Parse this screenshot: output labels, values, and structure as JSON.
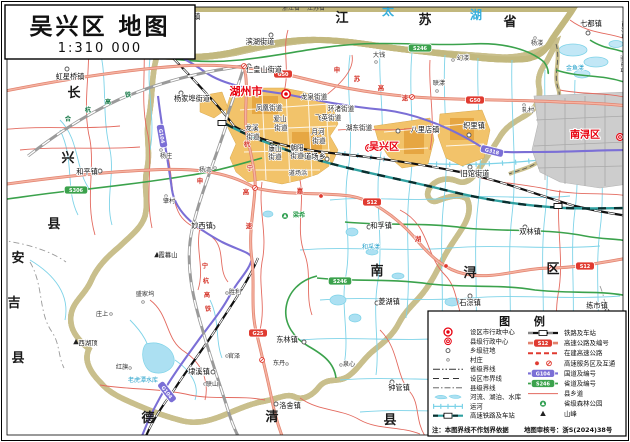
{
  "title": {
    "name": "吴兴区 地图",
    "scale": "1:310 000"
  },
  "colors": {
    "lake": "#C2E7F6",
    "district_fill": "#FCF9D2",
    "boundary_band": "#C9BF8C",
    "urban_orange": "#F2C36A",
    "urban_gray": "#CDCDCD",
    "highway": "#EE9B8C",
    "national_road": "#7B6FD6",
    "provincial_road": "#3BA24C",
    "county_road": "#E36A5F",
    "river": "#7ED3E8",
    "hsr_teal": "#2FA0A0",
    "badge_red": "#E03A30",
    "label_red": "#E8000E"
  },
  "map": {
    "labels": [
      {
        "t": "江",
        "x": 342,
        "y": 22,
        "c": "rg"
      },
      {
        "t": "苏",
        "x": 425,
        "y": 24,
        "c": "rg"
      },
      {
        "t": "省",
        "x": 510,
        "y": 26,
        "c": "rg"
      },
      {
        "t": "太",
        "x": 388,
        "y": 15,
        "c": "wb"
      },
      {
        "t": "湖",
        "x": 476,
        "y": 19,
        "c": "wb"
      },
      {
        "t": "长",
        "x": 74,
        "y": 97,
        "c": "rg"
      },
      {
        "t": "兴",
        "x": 68,
        "y": 162,
        "c": "rg"
      },
      {
        "t": "县",
        "x": 54,
        "y": 228,
        "c": "rg"
      },
      {
        "t": "安",
        "x": 18,
        "y": 262,
        "c": "rg"
      },
      {
        "t": "吉",
        "x": 14,
        "y": 307,
        "c": "rg"
      },
      {
        "t": "县",
        "x": 18,
        "y": 362,
        "c": "rg"
      },
      {
        "t": "德",
        "x": 148,
        "y": 422,
        "c": "rg"
      },
      {
        "t": "清",
        "x": 272,
        "y": 421,
        "c": "rg"
      },
      {
        "t": "县",
        "x": 390,
        "y": 424,
        "c": "rg"
      },
      {
        "t": "南",
        "x": 377,
        "y": 275,
        "c": "rg"
      },
      {
        "t": "浔",
        "x": 470,
        "y": 277,
        "c": "rg"
      },
      {
        "t": "区",
        "x": 553,
        "y": 273,
        "c": "rg"
      },
      {
        "t": "浙江省",
        "x": 291,
        "y": 10,
        "c": "pv"
      },
      {
        "t": "江苏省",
        "x": 316,
        "y": 10,
        "c": "pv"
      },
      {
        "t": "江苏省",
        "x": 622,
        "y": 30,
        "c": "pv",
        "r": 90
      },
      {
        "t": "浙江省",
        "x": 621,
        "y": 64,
        "c": "pv",
        "r": 90
      },
      {
        "t": "湖州市",
        "x": 246,
        "y": 95,
        "c": "ct"
      },
      {
        "t": "吴兴区",
        "x": 384,
        "y": 150,
        "c": "dt"
      },
      {
        "t": "南浔区",
        "x": 585,
        "y": 138,
        "c": "dt"
      },
      {
        "t": "李家巷镇",
        "x": 186,
        "y": 19,
        "c": "tn"
      },
      {
        "t": "虹星桥镇",
        "x": 70,
        "y": 79,
        "c": "tn"
      },
      {
        "t": "七都镇",
        "x": 591,
        "y": 26,
        "c": "tn"
      },
      {
        "t": "滨湖街道",
        "x": 260,
        "y": 44,
        "c": "tn"
      },
      {
        "t": "仁皇山街道",
        "x": 264,
        "y": 72,
        "c": "tn"
      },
      {
        "t": "杨家埠街道",
        "x": 192,
        "y": 101,
        "c": "tn"
      },
      {
        "t": "和平镇",
        "x": 87,
        "y": 174,
        "c": "tn"
      },
      {
        "t": "妙西镇",
        "x": 202,
        "y": 228,
        "c": "tn"
      },
      {
        "t": "埭溪镇",
        "x": 199,
        "y": 374,
        "c": "tn"
      },
      {
        "t": "东林镇",
        "x": 287,
        "y": 342,
        "c": "tn"
      },
      {
        "t": "洛舍镇",
        "x": 290,
        "y": 408,
        "c": "tn"
      },
      {
        "t": "钟管镇",
        "x": 399,
        "y": 390,
        "c": "tn"
      },
      {
        "t": "菱湖镇",
        "x": 389,
        "y": 304,
        "c": "tn"
      },
      {
        "t": "石淙镇",
        "x": 470,
        "y": 305,
        "c": "tn"
      },
      {
        "t": "练市镇",
        "x": 597,
        "y": 308,
        "c": "tn"
      },
      {
        "t": "双林镇",
        "x": 530,
        "y": 234,
        "c": "tn"
      },
      {
        "t": "和孚镇",
        "x": 381,
        "y": 228,
        "c": "tn"
      },
      {
        "t": "旧馆街道",
        "x": 475,
        "y": 176,
        "c": "tn"
      },
      {
        "t": "八里店镇",
        "x": 425,
        "y": 132,
        "c": "tn"
      },
      {
        "t": "织里镇",
        "x": 474,
        "y": 128,
        "c": "tn"
      },
      {
        "t": "道场乡",
        "x": 315,
        "y": 159,
        "c": "tn"
      },
      {
        "t": "龙泉街道",
        "x": 314,
        "y": 99,
        "c": "st"
      },
      {
        "t": "凤凰街道",
        "x": 269,
        "y": 110,
        "c": "st"
      },
      {
        "t": "环渚街道",
        "x": 341,
        "y": 111,
        "c": "st"
      },
      {
        "t": "飞英街道",
        "x": 328,
        "y": 120,
        "c": "st"
      },
      {
        "t": "湖东街道",
        "x": 359,
        "y": 130,
        "c": "st"
      },
      {
        "t": "爱山",
        "x": 280,
        "y": 121,
        "c": "st"
      },
      {
        "t": "街道",
        "x": 281,
        "y": 130,
        "c": "st"
      },
      {
        "t": "龙溪",
        "x": 252,
        "y": 130,
        "c": "st"
      },
      {
        "t": "街道",
        "x": 253,
        "y": 139,
        "c": "st"
      },
      {
        "t": "月河",
        "x": 318,
        "y": 134,
        "c": "st"
      },
      {
        "t": "街道",
        "x": 319,
        "y": 143,
        "c": "st"
      },
      {
        "t": "康山",
        "x": 275,
        "y": 151,
        "c": "st"
      },
      {
        "t": "街道",
        "x": 275,
        "y": 159,
        "c": "st"
      },
      {
        "t": "朝阳",
        "x": 297,
        "y": 150,
        "c": "st"
      },
      {
        "t": "街道",
        "x": 297,
        "y": 158,
        "c": "st"
      },
      {
        "t": "大钱",
        "x": 379,
        "y": 57,
        "c": "vg"
      },
      {
        "t": "幻溇",
        "x": 463,
        "y": 60,
        "c": "vg"
      },
      {
        "t": "杨溇",
        "x": 537,
        "y": 45,
        "c": "vg"
      },
      {
        "t": "联漾",
        "x": 439,
        "y": 85,
        "c": "vg"
      },
      {
        "t": "轧村",
        "x": 528,
        "y": 112,
        "c": "vg"
      },
      {
        "t": "杨庄",
        "x": 166,
        "y": 158,
        "c": "vg"
      },
      {
        "t": "杨湾",
        "x": 205,
        "y": 172,
        "c": "vg"
      },
      {
        "t": "肇村",
        "x": 169,
        "y": 203,
        "c": "vg"
      },
      {
        "t": "盛家坞",
        "x": 145,
        "y": 296,
        "c": "vg"
      },
      {
        "t": "庄上",
        "x": 102,
        "y": 316,
        "c": "vg"
      },
      {
        "t": "红旗",
        "x": 122,
        "y": 369,
        "c": "vg"
      },
      {
        "t": "联山",
        "x": 212,
        "y": 386,
        "c": "vg"
      },
      {
        "t": "官泽",
        "x": 234,
        "y": 358,
        "c": "vg"
      },
      {
        "t": "东丹",
        "x": 279,
        "y": 365,
        "c": "vg"
      },
      {
        "t": "泉心",
        "x": 349,
        "y": 366,
        "c": "vg"
      },
      {
        "t": "胜利",
        "x": 235,
        "y": 294,
        "c": "vg"
      },
      {
        "t": "道场浜",
        "x": 298,
        "y": 175,
        "c": "vg"
      },
      {
        "t": "霞幕山",
        "x": 168,
        "y": 257,
        "c": "pk"
      },
      {
        "t": "西湖顶",
        "x": 88,
        "y": 345,
        "c": "pk"
      },
      {
        "t": "老虎潭水库",
        "x": 143,
        "y": 382,
        "c": "ws"
      },
      {
        "t": "金鱼漾",
        "x": 575,
        "y": 70,
        "c": "ws"
      },
      {
        "t": "和孚漾",
        "x": 371,
        "y": 249,
        "c": "ws"
      },
      {
        "t": "合",
        "x": 68,
        "y": 121,
        "c": "rg2"
      },
      {
        "t": "杭",
        "x": 88,
        "y": 112,
        "c": "rg2"
      },
      {
        "t": "高",
        "x": 108,
        "y": 104,
        "c": "rg2"
      },
      {
        "t": "铁",
        "x": 128,
        "y": 97,
        "c": "rg2"
      },
      {
        "t": "宁",
        "x": 205,
        "y": 268,
        "c": "rr"
      },
      {
        "t": "杭",
        "x": 206,
        "y": 283,
        "c": "rr"
      },
      {
        "t": "高",
        "x": 207,
        "y": 297,
        "c": "rr"
      },
      {
        "t": "铁",
        "x": 208,
        "y": 311,
        "c": "rr"
      },
      {
        "t": "申",
        "x": 337,
        "y": 72,
        "c": "hc"
      },
      {
        "t": "苏",
        "x": 357,
        "y": 81,
        "c": "hc"
      },
      {
        "t": "高",
        "x": 381,
        "y": 90,
        "c": "hc"
      },
      {
        "t": "速",
        "x": 405,
        "y": 100,
        "c": "hc"
      },
      {
        "t": "申",
        "x": 200,
        "y": 183,
        "c": "hc"
      },
      {
        "t": "嘉",
        "x": 300,
        "y": 193,
        "c": "hc"
      },
      {
        "t": "湖",
        "x": 418,
        "y": 241,
        "c": "hc"
      },
      {
        "t": "杭",
        "x": 247,
        "y": 146,
        "c": "hc"
      },
      {
        "t": "宁",
        "x": 250,
        "y": 170,
        "c": "hc"
      },
      {
        "t": "高",
        "x": 246,
        "y": 194,
        "c": "hc"
      },
      {
        "t": "速",
        "x": 249,
        "y": 228,
        "c": "hc"
      },
      {
        "t": "梁希",
        "x": 299,
        "y": 217,
        "c": "pg"
      }
    ],
    "markers": [
      {
        "k": "city",
        "x": 286,
        "y": 94
      },
      {
        "k": "county",
        "x": 369,
        "y": 148
      },
      {
        "k": "county",
        "x": 620,
        "y": 137
      },
      {
        "k": "town",
        "x": 172,
        "y": 19
      },
      {
        "k": "town",
        "x": 67,
        "y": 69
      },
      {
        "k": "town",
        "x": 588,
        "y": 33
      },
      {
        "k": "town",
        "x": 271,
        "y": 35
      },
      {
        "k": "town",
        "x": 249,
        "y": 66
      },
      {
        "k": "town",
        "x": 181,
        "y": 93
      },
      {
        "k": "town",
        "x": 100,
        "y": 171
      },
      {
        "k": "town",
        "x": 213,
        "y": 227
      },
      {
        "k": "town",
        "x": 213,
        "y": 372
      },
      {
        "k": "town",
        "x": 304,
        "y": 342
      },
      {
        "k": "town",
        "x": 276,
        "y": 404
      },
      {
        "k": "town",
        "x": 392,
        "y": 382
      },
      {
        "k": "town",
        "x": 377,
        "y": 303
      },
      {
        "k": "town",
        "x": 470,
        "y": 296
      },
      {
        "k": "town",
        "x": 607,
        "y": 311
      },
      {
        "k": "town",
        "x": 525,
        "y": 227
      },
      {
        "k": "town",
        "x": 369,
        "y": 227
      },
      {
        "k": "town",
        "x": 470,
        "y": 167
      },
      {
        "k": "town",
        "x": 398,
        "y": 131
      },
      {
        "k": "town",
        "x": 469,
        "y": 135
      },
      {
        "k": "town",
        "x": 327,
        "y": 159
      },
      {
        "k": "village",
        "x": 376,
        "y": 62
      },
      {
        "k": "village",
        "x": 453,
        "y": 60
      },
      {
        "k": "village",
        "x": 535,
        "y": 38
      },
      {
        "k": "village",
        "x": 437,
        "y": 91
      },
      {
        "k": "village",
        "x": 524,
        "y": 105
      },
      {
        "k": "village",
        "x": 161,
        "y": 150
      },
      {
        "k": "village",
        "x": 215,
        "y": 168
      },
      {
        "k": "village",
        "x": 166,
        "y": 196
      },
      {
        "k": "village",
        "x": 143,
        "y": 302
      },
      {
        "k": "village",
        "x": 111,
        "y": 314
      },
      {
        "k": "village",
        "x": 130,
        "y": 368
      },
      {
        "k": "village",
        "x": 205,
        "y": 384
      },
      {
        "k": "village",
        "x": 227,
        "y": 356
      },
      {
        "k": "village",
        "x": 287,
        "y": 364
      },
      {
        "k": "village",
        "x": 341,
        "y": 365
      },
      {
        "k": "village",
        "x": 227,
        "y": 293
      },
      {
        "k": "peak",
        "x": 157,
        "y": 255
      },
      {
        "k": "peak",
        "x": 76,
        "y": 342
      },
      {
        "k": "station",
        "x": 222,
        "y": 123
      },
      {
        "k": "station",
        "x": 558,
        "y": 206
      },
      {
        "k": "service",
        "x": 321,
        "y": 196
      },
      {
        "k": "service",
        "x": 446,
        "y": 266
      },
      {
        "k": "interchange",
        "x": 244,
        "y": 66
      },
      {
        "k": "interchange",
        "x": 412,
        "y": 97
      },
      {
        "k": "interchange",
        "x": 255,
        "y": 188
      },
      {
        "k": "interchange",
        "x": 550,
        "y": 268
      },
      {
        "k": "interchange",
        "x": 262,
        "y": 360
      },
      {
        "k": "park",
        "x": 285,
        "y": 216
      }
    ],
    "badges": [
      {
        "t": "G50",
        "x": 283,
        "y": 74,
        "k": "hw"
      },
      {
        "t": "G50",
        "x": 475,
        "y": 100,
        "k": "hw"
      },
      {
        "t": "S12",
        "x": 372,
        "y": 202,
        "k": "hw"
      },
      {
        "t": "S12",
        "x": 585,
        "y": 266,
        "k": "hw"
      },
      {
        "t": "G25",
        "x": 258,
        "y": 333,
        "k": "hw"
      },
      {
        "t": "G318",
        "x": 134,
        "y": 46,
        "k": "g"
      },
      {
        "t": "G318",
        "x": 492,
        "y": 151,
        "k": "g",
        "r": 14
      },
      {
        "t": "G104",
        "x": 162,
        "y": 136,
        "k": "g",
        "r": 80
      },
      {
        "t": "G104",
        "x": 167,
        "y": 392,
        "k": "g",
        "r": 52
      },
      {
        "t": "S306",
        "x": 76,
        "y": 190,
        "k": "s"
      },
      {
        "t": "S246",
        "x": 420,
        "y": 48,
        "k": "s"
      },
      {
        "t": "S246",
        "x": 340,
        "y": 281,
        "k": "s"
      }
    ]
  },
  "legend": {
    "title": "图  例",
    "left": [
      {
        "sym": "city",
        "label": "设区市行政中心"
      },
      {
        "sym": "county",
        "label": "县级行政中心"
      },
      {
        "sym": "township",
        "label": "乡级驻地"
      },
      {
        "sym": "village",
        "label": "村庄"
      },
      {
        "sym": "prov-border",
        "label": "省级界线"
      },
      {
        "sym": "city-border",
        "label": "设区市界线"
      },
      {
        "sym": "county-border",
        "label": "县级界线"
      },
      {
        "sym": "water",
        "label": "河流、湖泊、水库"
      },
      {
        "sym": "canal",
        "label": "运河"
      },
      {
        "sym": "hsr",
        "label": "高速铁路及车站"
      }
    ],
    "right": [
      {
        "sym": "rail",
        "label": "铁路及车站"
      },
      {
        "sym": "hwy-badge",
        "label": "高速公路及编号",
        "badge": "S12"
      },
      {
        "sym": "hwy-constr",
        "label": "在建高速公路"
      },
      {
        "sym": "service-ic",
        "label": "高速服务区及互通"
      },
      {
        "sym": "g-badge",
        "label": "国道及编号",
        "badge": "G104"
      },
      {
        "sym": "s-badge",
        "label": "省道及编号",
        "badge": "S246"
      },
      {
        "sym": "county-road",
        "label": "县乡道"
      },
      {
        "sym": "park",
        "label": "省级森林公园"
      },
      {
        "sym": "peak",
        "label": "山峰"
      }
    ],
    "note": "注：本图界线不作划界依据",
    "approval": "地图审核号：浙S(2024)38号"
  }
}
